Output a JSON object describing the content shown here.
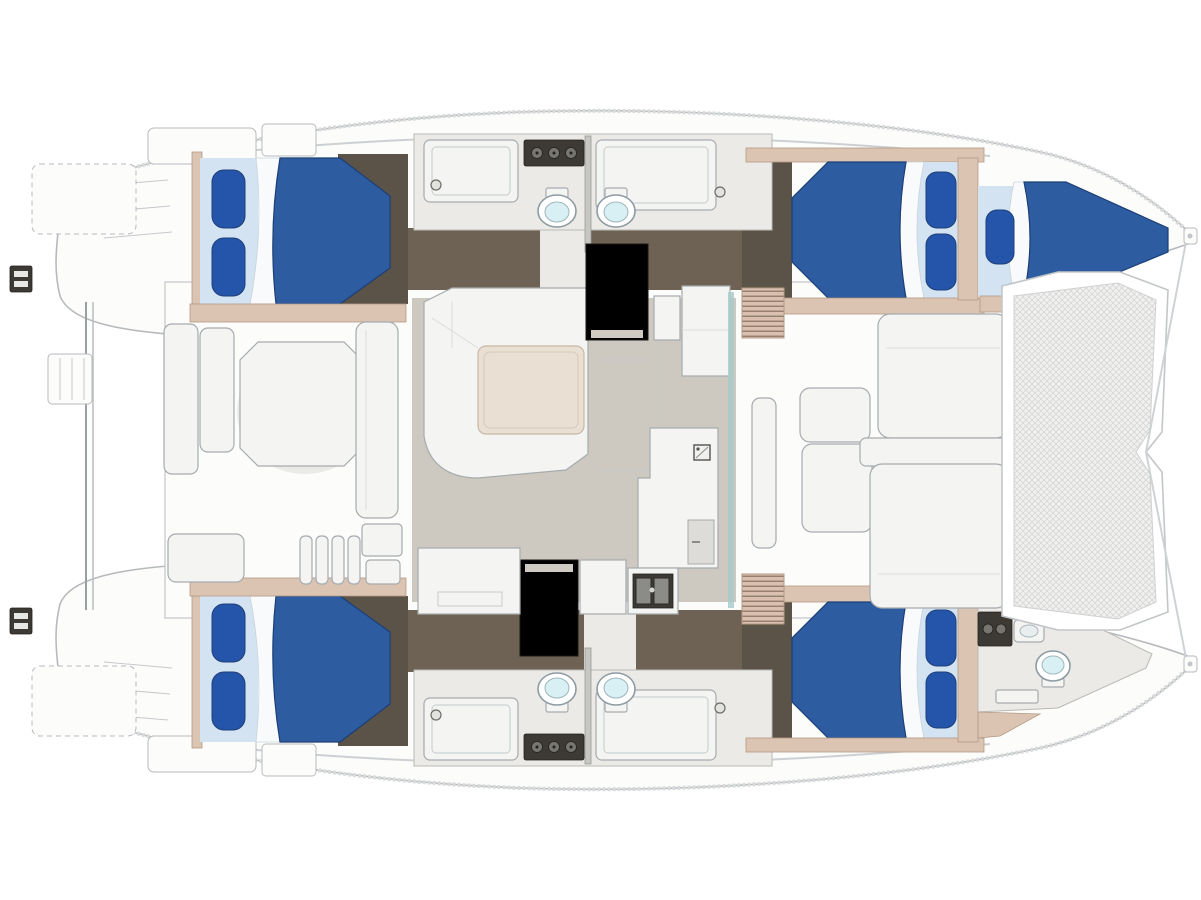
{
  "page": {
    "background": "#ffffff",
    "width": 1201,
    "height": 900
  },
  "diagram": {
    "kind": "boat-floor-plan",
    "vessel_type": "sailing-catamaran",
    "view": "overhead-accommodation-layout"
  },
  "colors": {
    "deck_white": "#fcfcfb",
    "deck_stroke": "#b7babc",
    "interior_dark_floor": "#6e6254",
    "wardrobe_dark": "#5c5348",
    "cabin_floor_light": "#eceae6",
    "salon_floor": "#cdc9c0",
    "tan": "#dcc4b2",
    "tan_stroke": "#b49a86",
    "bed_blue": "#2d5ca0",
    "bed_blue_dark": "#1c3f77",
    "pillow_blue": "#2455ab",
    "pillow_band": "#d4e3f1",
    "sheet_white": "#f8fafc",
    "furn_white": "#f4f4f2",
    "furn_stroke": "#a6abae",
    "table_beige": "#e9dfd3",
    "toilet_bowl": "#d8eff3",
    "fixture_dark": "#3d3a36",
    "glass_teal": "#a8cbca",
    "tramp_bg": "#f1f1f0",
    "tramp_line": "#d7d7d6",
    "louver_pink": "#dcc0af",
    "louver_line": "#7c695c"
  },
  "vessel": {
    "bow_feature": "trampoline-net",
    "stern_feature": "twin-transom-platforms-with-crossbar",
    "port_hull": {
      "aft_cabin": "double-berth",
      "midship": "head-with-twin-toilets-and-showers",
      "forward_cabin": "double-berth",
      "forepeak": "single-berth"
    },
    "starboard_hull": {
      "aft_cabin": "double-berth",
      "midship": "head-with-twin-toilets-and-showers",
      "forward_cabin": "double-berth",
      "forepeak": "bow-head-with-toilet"
    },
    "bridge_deck": {
      "aft": "cockpit-with-table-and-benches",
      "center": "salon-dinette-galley-stairwells",
      "forward": "forward-cockpit-seating"
    },
    "counts": {
      "double_berths": 4,
      "single_berths": 1,
      "toilets": 5,
      "showers": 4,
      "cockpit_tables": 1,
      "salon_tables": 1
    }
  }
}
